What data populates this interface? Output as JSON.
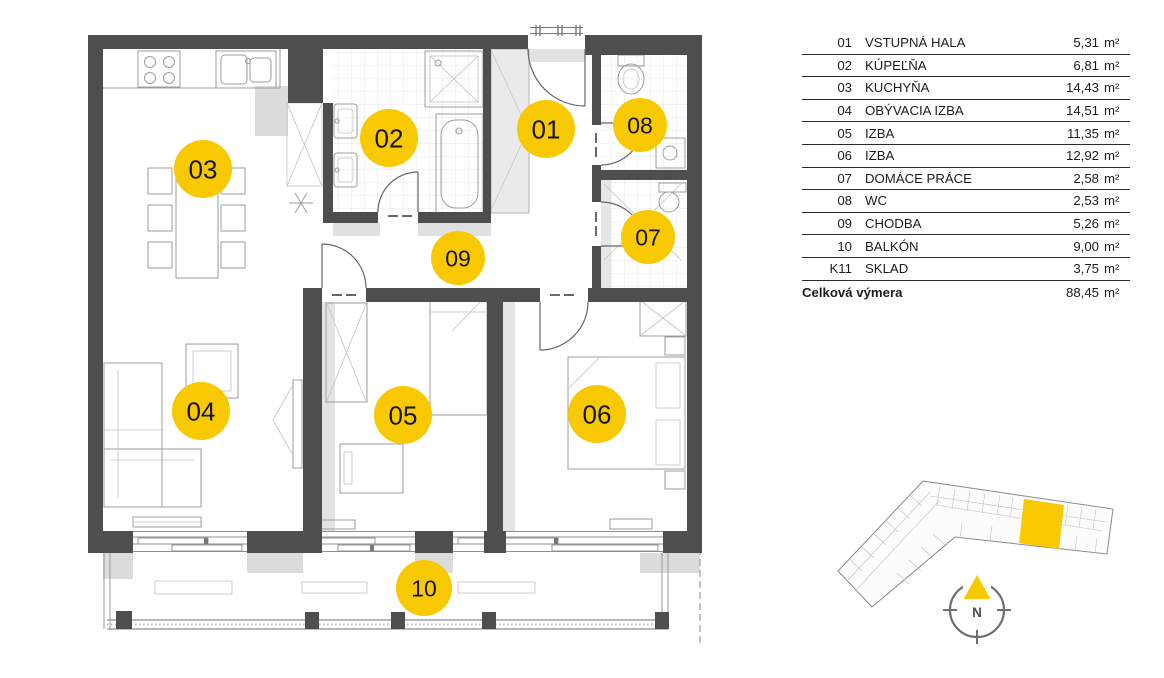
{
  "legend": {
    "rows": [
      {
        "code": "01",
        "name": "VSTUPNÁ HALA",
        "area": "5,31"
      },
      {
        "code": "02",
        "name": "KÚPEĽŇA",
        "area": "6,81"
      },
      {
        "code": "03",
        "name": "KUCHYŇA",
        "area": "14,43"
      },
      {
        "code": "04",
        "name": "OBÝVACIA IZBA",
        "area": "14,51"
      },
      {
        "code": "05",
        "name": "IZBA",
        "area": "11,35"
      },
      {
        "code": "06",
        "name": "IZBA",
        "area": "12,92"
      },
      {
        "code": "07",
        "name": "DOMÁCE PRÁCE",
        "area": "2,58"
      },
      {
        "code": "08",
        "name": "WC",
        "area": "2,53"
      },
      {
        "code": "09",
        "name": "CHODBA",
        "area": "5,26"
      },
      {
        "code": "10",
        "name": "BALKÓN",
        "area": "9,00"
      },
      {
        "code": "K11",
        "name": "SKLAD",
        "area": "3,75"
      }
    ],
    "unit": "m²",
    "total": {
      "label": "Celková výmera",
      "area": "88,45"
    }
  },
  "plan": {
    "rooms": [
      {
        "number": "01"
      },
      {
        "number": "02"
      },
      {
        "number": "03"
      },
      {
        "number": "04"
      },
      {
        "number": "05"
      },
      {
        "number": "06"
      },
      {
        "number": "07"
      },
      {
        "number": "08"
      },
      {
        "number": "09"
      },
      {
        "number": "10"
      }
    ]
  },
  "compass": {
    "north_label": "N"
  },
  "colors": {
    "accent": "#F8C900",
    "wall": "#4E4E4E"
  }
}
